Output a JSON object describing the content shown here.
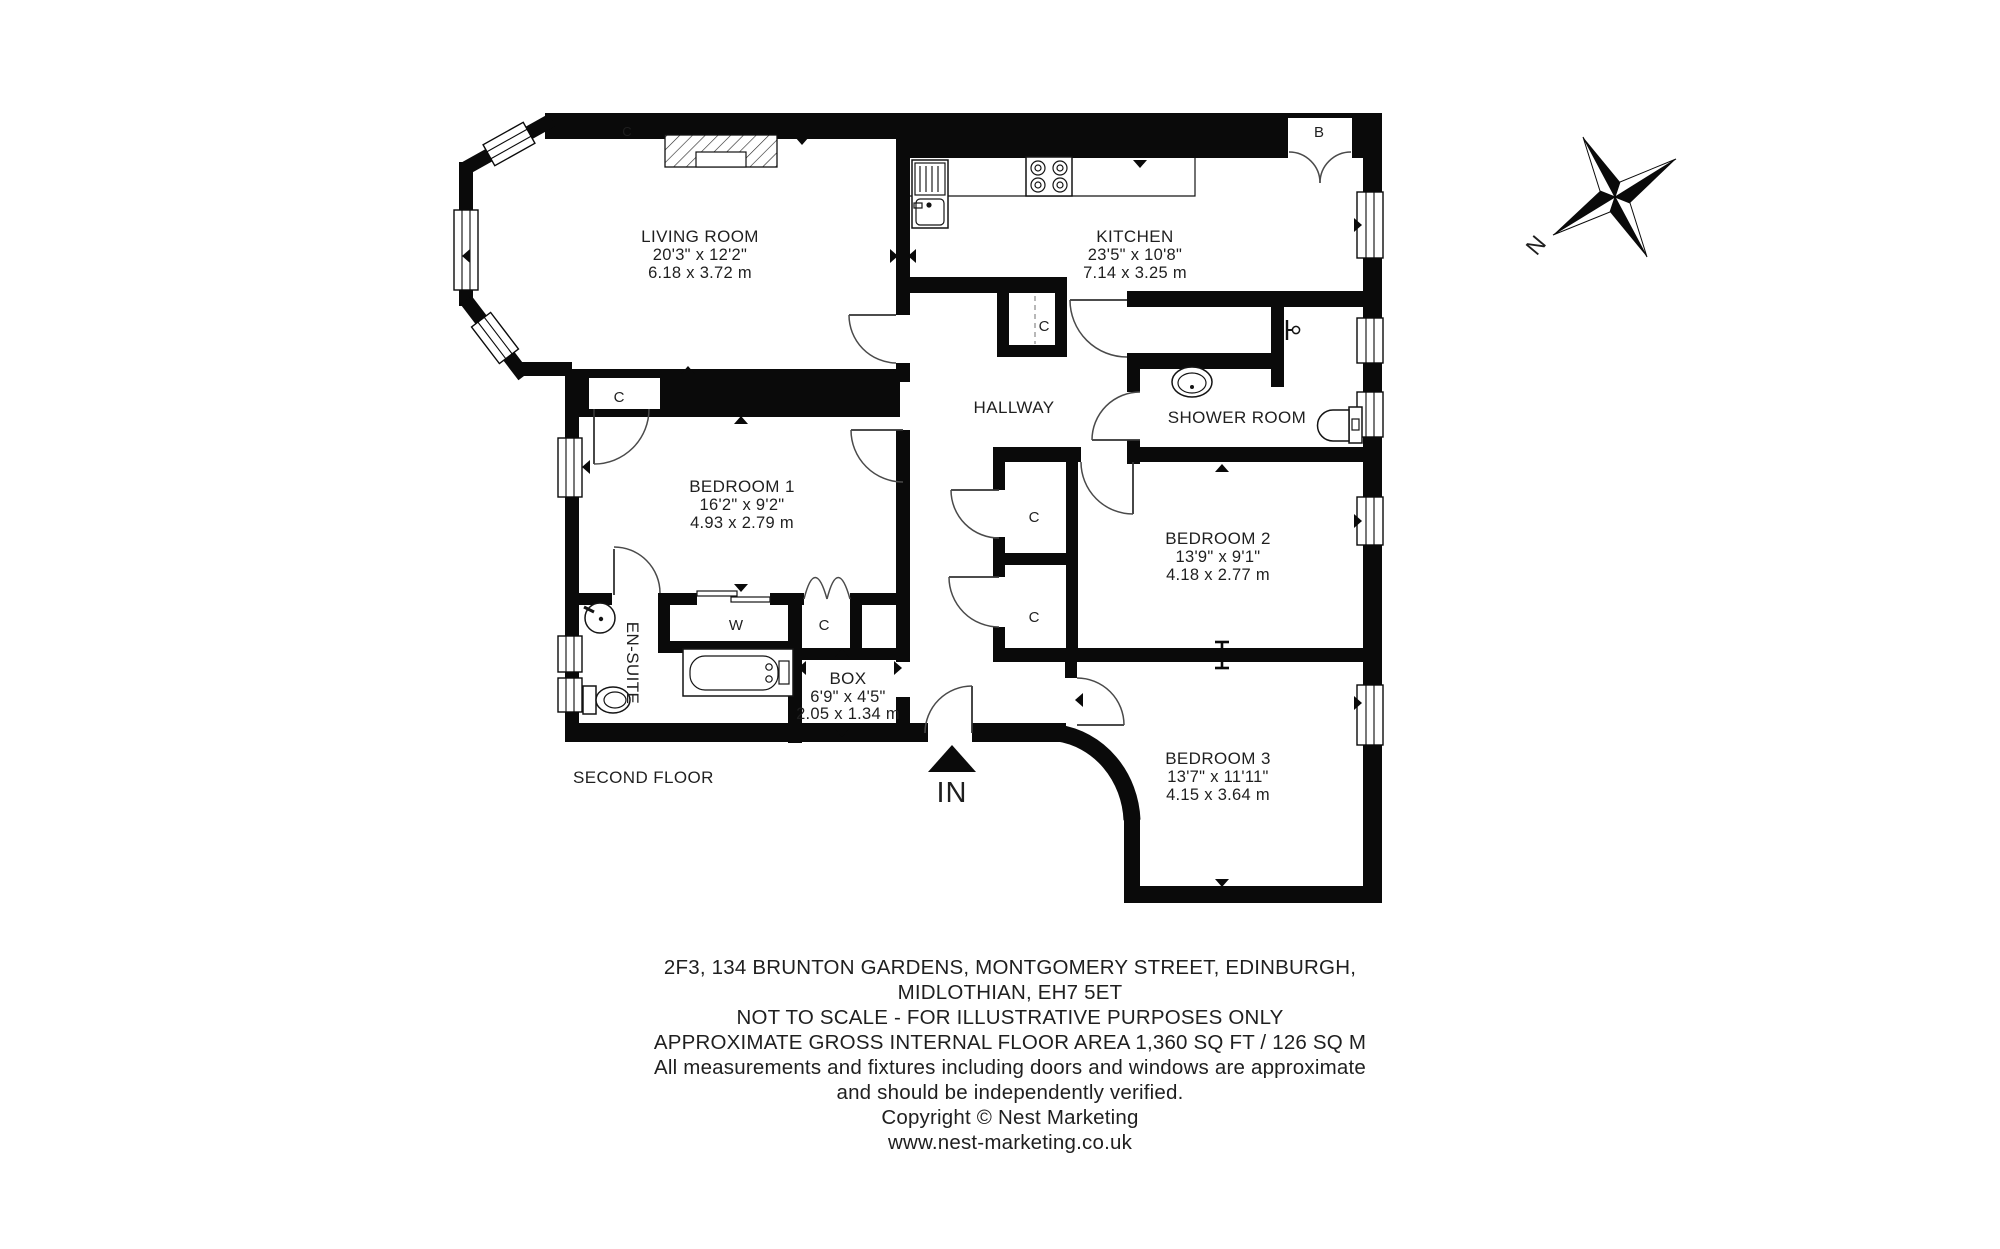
{
  "floorplan": {
    "floor_label": "SECOND FLOOR",
    "entrance": {
      "label": "IN"
    },
    "compass": {
      "label": "N"
    },
    "rooms": [
      {
        "id": "living-room",
        "name": "LIVING ROOM",
        "dims_imperial": "20'3\" x 12'2\"",
        "dims_metric": "6.18 x 3.72 m"
      },
      {
        "id": "kitchen",
        "name": "KITCHEN",
        "dims_imperial": "23'5\" x 10'8\"",
        "dims_metric": "7.14 x 3.25 m"
      },
      {
        "id": "hallway",
        "name": "HALLWAY"
      },
      {
        "id": "shower-room",
        "name": "SHOWER ROOM"
      },
      {
        "id": "bedroom-1",
        "name": "BEDROOM 1",
        "dims_imperial": "16'2\" x 9'2\"",
        "dims_metric": "4.93 x 2.79 m"
      },
      {
        "id": "bedroom-2",
        "name": "BEDROOM 2",
        "dims_imperial": "13'9\" x 9'1\"",
        "dims_metric": "4.18 x 2.77 m"
      },
      {
        "id": "bedroom-3",
        "name": "BEDROOM 3",
        "dims_imperial": "13'7\" x 11'11\"",
        "dims_metric": "4.15 x 3.64 m"
      },
      {
        "id": "box-room",
        "name": "BOX",
        "dims_imperial": "6'9\" x 4'5\"",
        "dims_metric": "2.05 x 1.34 m"
      },
      {
        "id": "en-suite",
        "name": "EN-SUITE"
      }
    ],
    "markers": {
      "cupboard": "C",
      "wardrobe": "W",
      "boiler": "B"
    }
  },
  "footer": {
    "lines": [
      "2F3, 134 BRUNTON GARDENS, MONTGOMERY STREET, EDINBURGH,",
      "MIDLOTHIAN, EH7 5ET",
      "NOT TO SCALE - FOR ILLUSTRATIVE PURPOSES ONLY",
      "APPROXIMATE GROSS INTERNAL FLOOR AREA 1,360 SQ FT / 126 SQ M",
      "All measurements and fixtures including doors and windows are approximate",
      "and should be independently verified.",
      "Copyright © Nest Marketing",
      "www.nest-marketing.co.uk"
    ]
  },
  "colors": {
    "wall": "#0a0a0a",
    "door_arc": "#4a4a4a",
    "text": "#1f1f1f",
    "background": "#ffffff"
  }
}
